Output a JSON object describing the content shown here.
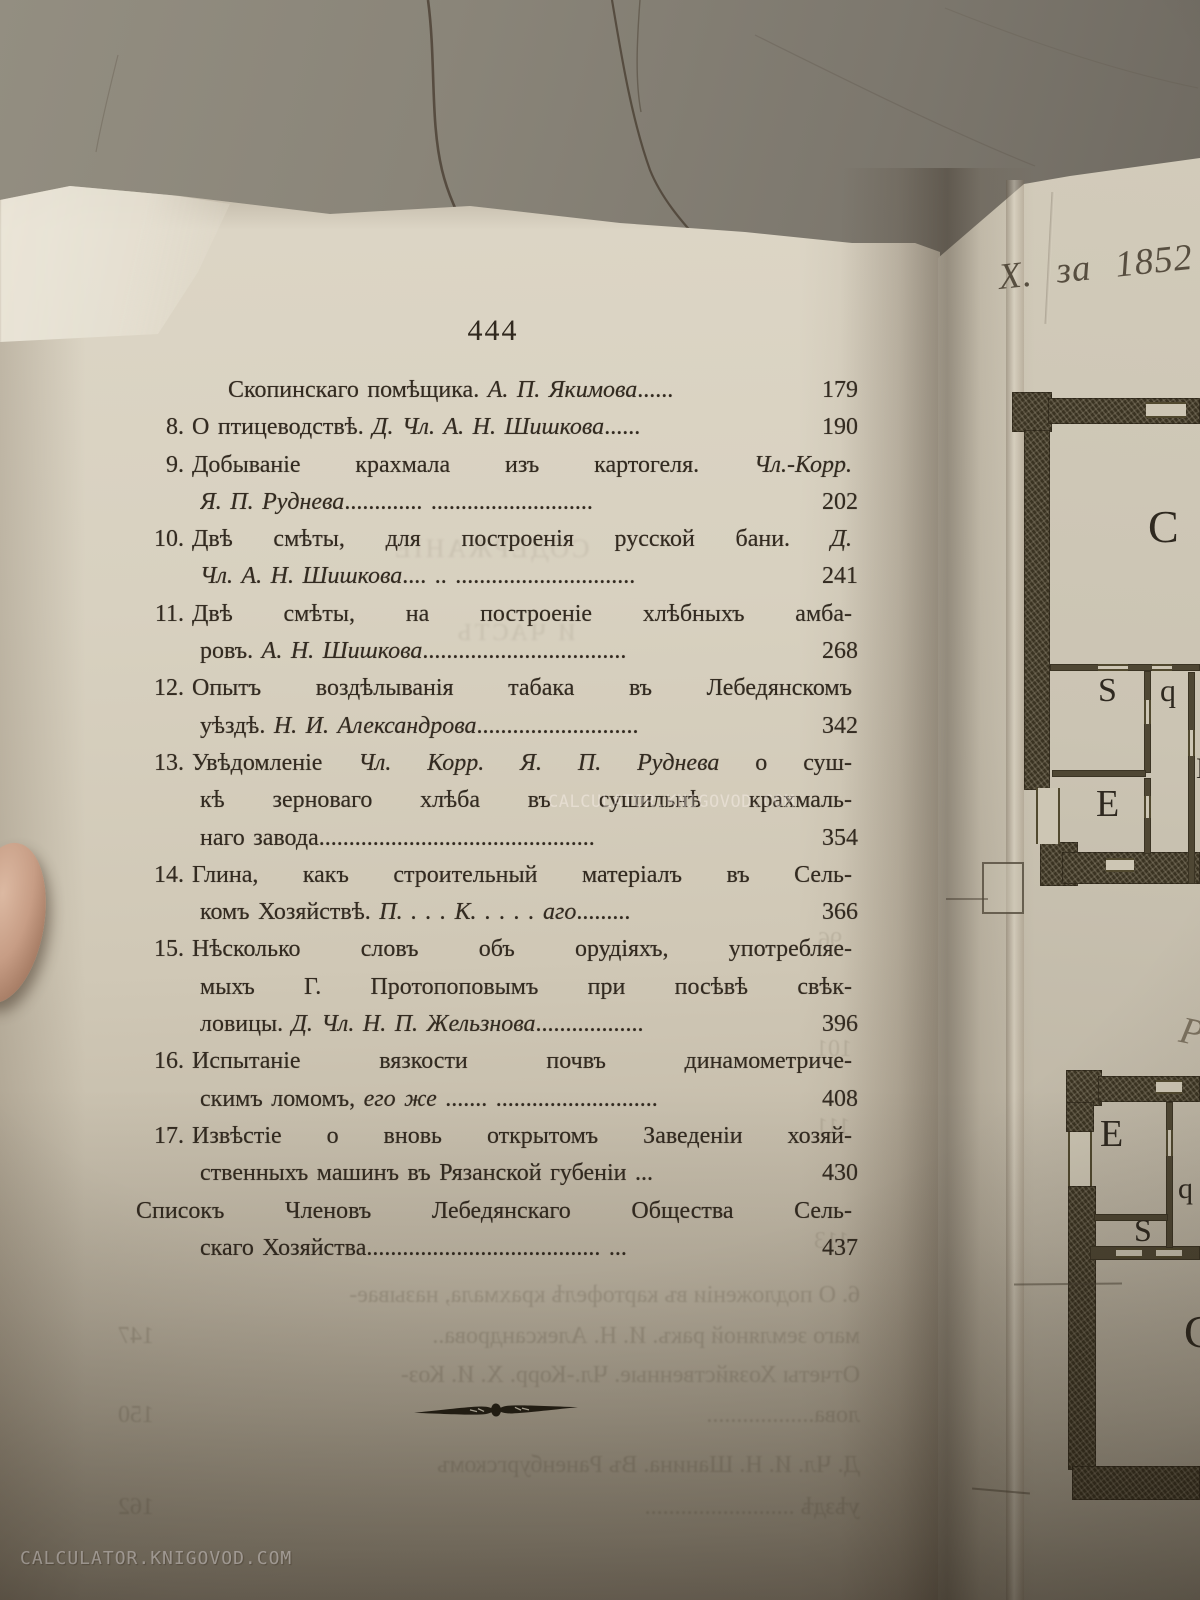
{
  "left_page": {
    "page_number": "444",
    "toc_lines": [
      {
        "ind": 3,
        "num": "",
        "pre": "Скопинскаго помѣщика. ",
        "it": "А. П. Якимова",
        "post": "......",
        "page": "179"
      },
      {
        "ind": 1,
        "num": "8.",
        "pre": "О птицеводствѣ. ",
        "it": "Д. Чл. А. Н. Шишкова",
        "post": "......",
        "page": "190"
      },
      {
        "ind": 1,
        "num": "9.",
        "pre": "Добываніе крахмала изъ картогеля. ",
        "it": "Чл.-Корр.",
        "post": "",
        "page": ""
      },
      {
        "ind": 2,
        "num": "",
        "pre": "",
        "it": "Я. П. Руднева",
        "post": "............. ...........................",
        "page": "202"
      },
      {
        "ind": 1,
        "num": "10.",
        "pre": "Двѣ смѣты, для построенія русской бани. ",
        "it": "Д.",
        "post": "",
        "page": ""
      },
      {
        "ind": 2,
        "num": "",
        "pre": "",
        "it": "Чл. А. Н. Шишкова",
        "post": ".... .. ..............................",
        "page": "241"
      },
      {
        "ind": 1,
        "num": "11.",
        "pre": "Двѣ смѣты, на построеніе хлѣбныхъ амба-",
        "it": "",
        "post": "",
        "page": ""
      },
      {
        "ind": 2,
        "num": "",
        "pre": "ровъ. ",
        "it": "А. Н. Шишкова",
        "post": "..................................",
        "page": "268"
      },
      {
        "ind": 1,
        "num": "12.",
        "pre": "Опытъ воздѣлыванія табака въ Лебедянскомъ",
        "it": "",
        "post": "",
        "page": ""
      },
      {
        "ind": 2,
        "num": "",
        "pre": "уѣздѣ. ",
        "it": "Н. И. Александрова",
        "post": "...........................",
        "page": "342"
      },
      {
        "ind": 1,
        "num": "13.",
        "pre": "Увѣдомленіе ",
        "it": "Чл. Корр. Я. П. Руднева",
        "post": " о суш-",
        "page": ""
      },
      {
        "ind": 2,
        "num": "",
        "pre": "кѣ зерноваго хлѣба въ сушильнѣ крахмаль-",
        "it": "",
        "post": "",
        "page": ""
      },
      {
        "ind": 2,
        "num": "",
        "pre": "наго завода",
        "it": "",
        "post": "..............................................",
        "page": "354"
      },
      {
        "ind": 1,
        "num": "14.",
        "pre": "Глина, какъ строительный матеріалъ въ Сель-",
        "it": "",
        "post": "",
        "page": ""
      },
      {
        "ind": 2,
        "num": "",
        "pre": "комъ Хозяйствѣ. ",
        "it": "П. . . . К. . . . . аго",
        "post": ".........",
        "page": "366"
      },
      {
        "ind": 1,
        "num": "15.",
        "pre": "Нѣсколько словъ объ орудіяхъ, употребляе-",
        "it": "",
        "post": "",
        "page": ""
      },
      {
        "ind": 2,
        "num": "",
        "pre": "мыхъ Г. Протопоповымъ при посѣвѣ свѣк-",
        "it": "",
        "post": "",
        "page": ""
      },
      {
        "ind": 2,
        "num": "",
        "pre": "ловицы. ",
        "it": "Д. Чл. Н. П. Жельзнова",
        "post": "..................",
        "page": "396"
      },
      {
        "ind": 1,
        "num": "16.",
        "pre": "Испытаніе вязкости почвъ динамометриче-",
        "it": "",
        "post": "",
        "page": ""
      },
      {
        "ind": 2,
        "num": "",
        "pre": "скимъ ломомъ, ",
        "it": "его же",
        "post": " ....... ...........................",
        "page": "408"
      },
      {
        "ind": 1,
        "num": "17.",
        "pre": "Извѣстіе о вновь открытомъ Заведеніи хозяй-",
        "it": "",
        "post": "",
        "page": ""
      },
      {
        "ind": 2,
        "num": "",
        "pre": "ственныхъ машинъ въ Рязанской губеніи ...",
        "it": "",
        "post": "",
        "page": "430"
      },
      {
        "ind": 0,
        "num": "",
        "pre": "Списокъ Членовъ Лебедянскаго Общества Сель-",
        "it": "",
        "post": "",
        "page": ""
      },
      {
        "ind": 2,
        "num": "",
        "pre": "скаго Хозяйства",
        "it": "",
        "post": "....................................... ...",
        "page": "437"
      }
    ]
  },
  "plate": {
    "handwriting": "Х. за 1852",
    "upper_plan": {
      "c": "C",
      "s": "S",
      "q": "q",
      "e": "E",
      "partial": "Б"
    },
    "lower_plan": {
      "e": "E",
      "q": "q",
      "s": "S",
      "c": "C"
    },
    "script_letter": "Р"
  },
  "bleedthrough": {
    "header_ghost": "СОДЕРЖАНІЕ",
    "subheader_ghost": "И ЧАСТЬ",
    "margin_numbers": [
      "96",
      "101",
      "111",
      "113"
    ],
    "bottom_lines": [
      {
        "text": "6. О подложеніи въ картофелѣ крахмала, называе-",
        "page": ""
      },
      {
        "text": "маго земляной ракъ. И. Н. Александрова..",
        "page": "147"
      },
      {
        "text": "Отчеты Хозяйственные. Чл.-Корр. Х. И. Коз-",
        "page": ""
      },
      {
        "text": "лова..................",
        "page": "150"
      },
      {
        "text": "Д. Чл. И. Н. Шанина. Въ Раненбургскомъ",
        "page": ""
      },
      {
        "text": "уѣздѣ .........................",
        "page": "162"
      }
    ]
  },
  "watermarks": {
    "center": "CALCULATOR.KNIGOVOD.COM",
    "bottom_left": "CALCULATOR.KNIGOVOD.COM"
  }
}
